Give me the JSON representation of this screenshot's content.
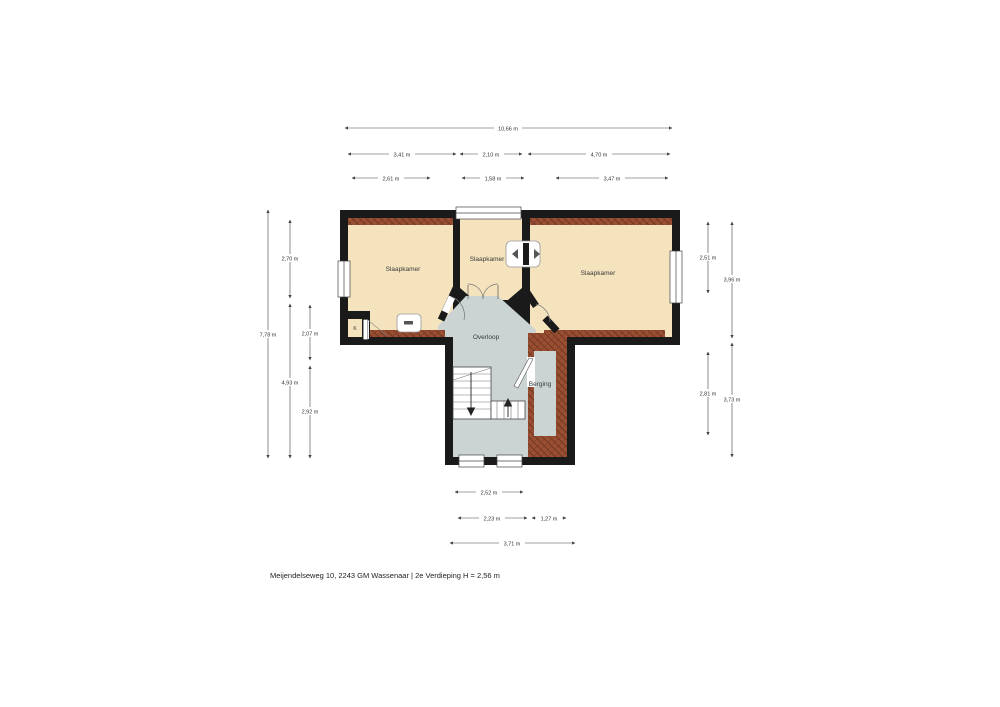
{
  "footer": {
    "caption": "Meijendelseweg 10, 2243 GM Wassenaar | 2e Verdieping H = 2,56 m"
  },
  "floorplan": {
    "rooms": {
      "bedroom_left": "Slaapkamer",
      "bedroom_middle": "Slaapkamer",
      "bedroom_right": "Slaapkamer",
      "landing": "Overloop",
      "storage": "Berging",
      "closet": "K"
    },
    "dimensions": {
      "top": {
        "total": "10,66 m",
        "segments": [
          "3,41 m",
          "2,10 m",
          "4,70 m"
        ],
        "inner_segments": [
          "2,61 m",
          "1,58 m",
          "3,47 m"
        ]
      },
      "left": {
        "total": "7,78 m",
        "segments": [
          "2,70 m",
          "4,93 m"
        ],
        "inner_segments": [
          "2,07 m",
          "2,92 m"
        ]
      },
      "right": {
        "outer_segments": [
          "3,96 m",
          "3,73 m"
        ],
        "inner_segments": [
          "2,51 m",
          "2,81 m"
        ]
      },
      "bottom": {
        "stair_width": "2,52 m",
        "segments": [
          "2,23 m",
          "1,27 m"
        ],
        "total": "3,71 m"
      }
    },
    "colors": {
      "wall": "#1a1a1a",
      "room_fill": "#f4e3bd",
      "floor_gray": "#ccd3d3",
      "hatch_brown": "#94492d",
      "hatch_line": "#5c2b19",
      "window_fill": "#ffffff",
      "dimension_line": "#444444"
    }
  }
}
